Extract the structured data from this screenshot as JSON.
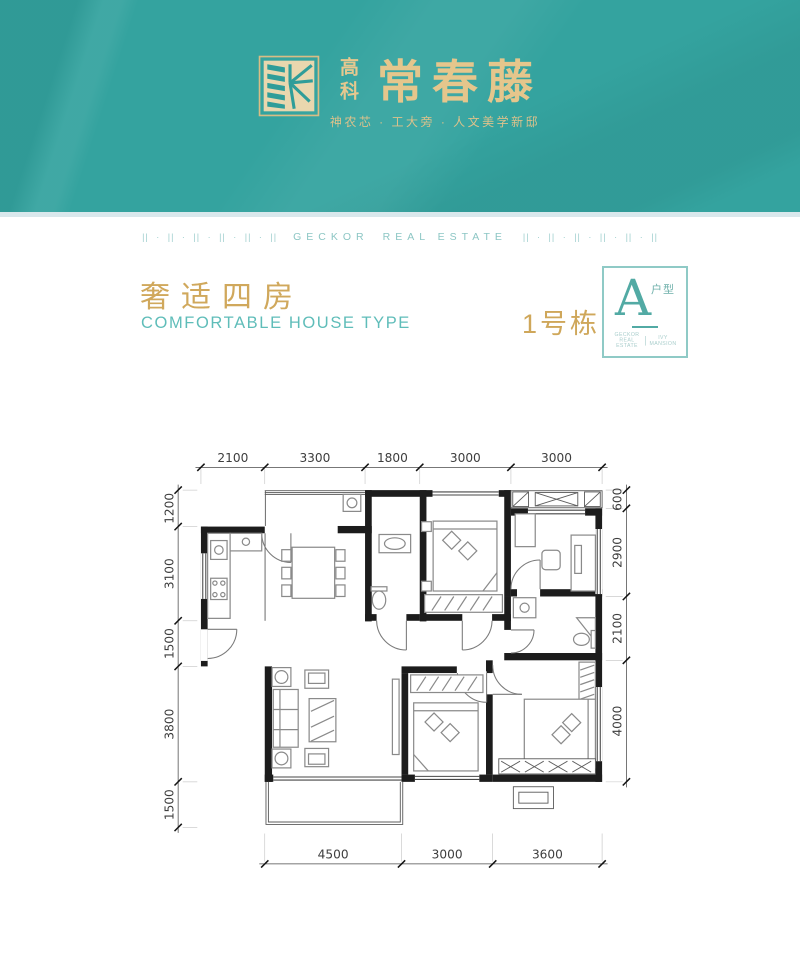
{
  "header": {
    "logo_small": "高科",
    "logo_big": "常春藤",
    "tagline": "神农芯 · 工大旁 · 人文美学新邸"
  },
  "divider": {
    "pattern_left": "|| · || · || · || · || · ||",
    "brand_1": "GECKOR",
    "brand_2": "REAL ESTATE",
    "pattern_right": "|| · || · || · || · || · ||"
  },
  "title": {
    "cn": "奢适四房",
    "en": "COMFORTABLE HOUSE TYPE",
    "building": "1号栋",
    "unit_letter": "A",
    "unit_type": "户型",
    "badge_foot_left": "GECKOR REAL ESTATE",
    "badge_foot_right": "IVY MANSION"
  },
  "colors": {
    "header_teal": "#34a39f",
    "gold": "#d0a85c",
    "divider_teal": "#9ecfce",
    "wall_black": "#1c1c1c"
  },
  "floorplan": {
    "dims_top": [
      "2100",
      "3300",
      "1800",
      "3000",
      "3000"
    ],
    "dims_left": [
      "1200",
      "3100",
      "1500",
      "3800",
      "1500"
    ],
    "dims_right": [
      "600",
      "2900",
      "2100",
      "4000"
    ],
    "dims_bottom": [
      "4500",
      "3000",
      "3600"
    ]
  }
}
